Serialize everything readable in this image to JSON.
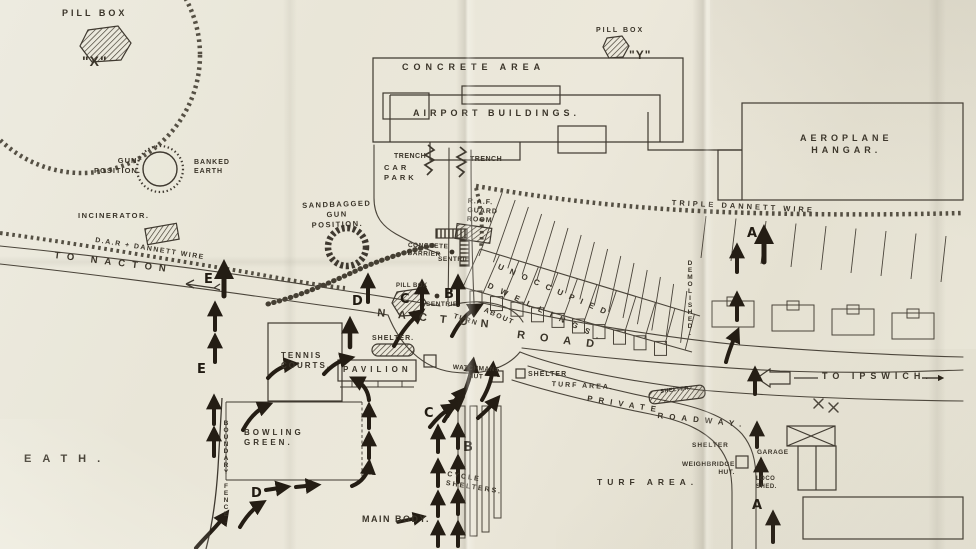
{
  "colors": {
    "paper": "#e9e6d8",
    "ink": "#3a3429",
    "arrow": "#241d14"
  },
  "labels": {
    "pill_box_x": "PILL BOX",
    "x_marker": "\"X\"",
    "pill_box_y": "PILL BOX",
    "y_marker": "\"Y\"",
    "gun_position": "GUN-\nPOSITION.",
    "banked_earth": "BANKED\nEARTH",
    "incinerator": "INCINERATOR.",
    "dar_dannett_wire": "D.A.R + DANNETT WIRE",
    "to_nacton": "TO NACTON",
    "sandbagged_gun": "SANDBAGGED\nGUN\nPOSITION.",
    "concrete_area": "CONCRETE AREA",
    "airport_buildings": "AIRPORT BUILDINGS.",
    "trench_1": "TRENCH",
    "trench_2": "TRENCH",
    "car_park": "CAR\nPARK",
    "aeroplane_hangar": "AEROPLANE\nHANGAR.",
    "triple_dannett_wire": "TRIPLE DANNETT WIRE",
    "raf_guard_room": "R.A.F.\nGUARD\nROOM",
    "concrete_barrier": "CONCRETE\nBARRIER",
    "sentrie_1": "SENTRIE",
    "sentrie_2": "SENTRIE.",
    "pill_box_small": "PILL BOX",
    "nacton_road": {
      "w1": "NACTON",
      "w2": "ROAD"
    },
    "turn_about": {
      "w1": "TURN",
      "w2": "ABOUT"
    },
    "unoccupied": "UNOCCUPIED",
    "dwellings": "DWELLINGS.",
    "demolished": "DEMOLISHED.",
    "to_ipswich": "TO IPSWICH.",
    "tennis_courts": "TENNIS\nCOURTS.",
    "pavilion": "PAVILION",
    "shelter_pavilion": "SHELTER.",
    "watchmans_hut": "WATCHMANS\nHUT",
    "shelter_turf": "SHELTER",
    "turf_area_1": "TURF AREA.",
    "private_roadway": {
      "w1": "PRIVATE",
      "w2": "ROADWAY."
    },
    "shelter_banner": "SHELTER",
    "bowling_green": "BOWLING\nGREEN.",
    "boundary_fence": "BOUNDARY FENCE.",
    "cycle_shelters": "CYCLE\nSHELTERS.",
    "main_body": "MAIN BODY.",
    "turf_area_2": "TURF AREA.",
    "shelter_right": "SHELTER",
    "weighbridge_hut": "WEIGHBRIDGE\nHUT.",
    "garage": "GARAGE",
    "loco_shed": "LOCO\nSHED.",
    "heath": "EATH."
  },
  "routes": {
    "a": "A",
    "b": "B",
    "c": "C",
    "d": "D",
    "e": "E"
  }
}
